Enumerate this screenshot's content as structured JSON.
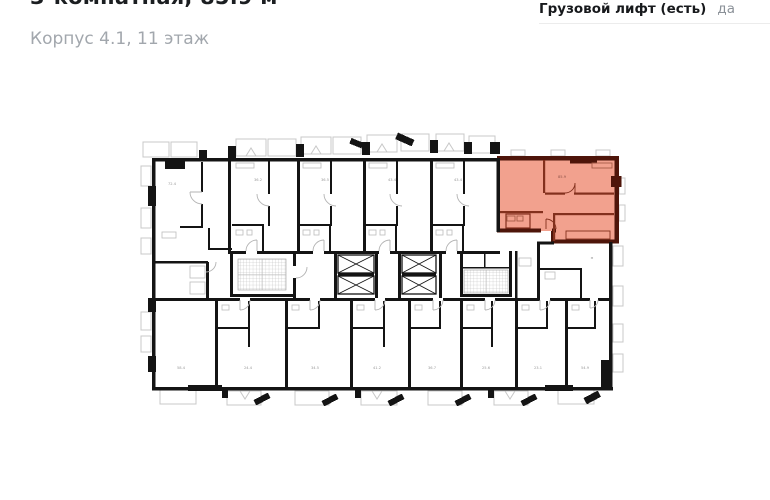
{
  "header": {
    "title_clipped": "3-комнатная, 85.9 м²",
    "subtitle": "Корпус 4.1, 11 этаж",
    "info_label": "Грузовой лифт (есть)",
    "info_value": "да"
  },
  "plan": {
    "highlight_fill": "#F2A18E",
    "highlight_wall": "#4E150A",
    "highlight_inner_wall": "#83301D",
    "wall_color": "#141414",
    "detail_color": "#C8C8C8",
    "label_color": "#9A9A9A",
    "highlight_label": "85.9",
    "top_row_labels": [
      "72.4",
      "36.2",
      "36.5",
      "43.4",
      "43.4"
    ],
    "bottom_row_labels": [
      "58.4",
      "24.4",
      "34.5",
      "41.2",
      "36.7",
      "25.6",
      "23.1",
      "54.9"
    ],
    "middle_right_label": "м"
  }
}
